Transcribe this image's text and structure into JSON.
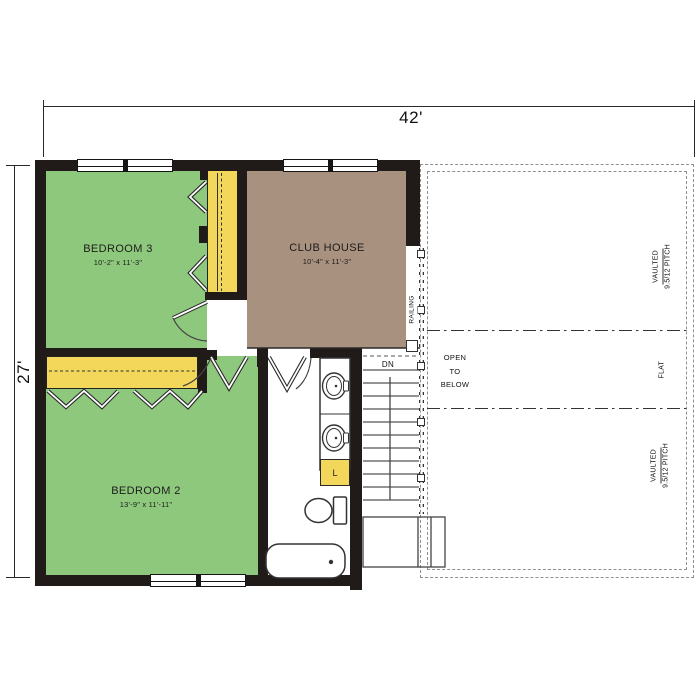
{
  "title": "Second floor plan",
  "dimensions": {
    "top": "42'",
    "left": "27'"
  },
  "rooms": [
    {
      "name": "BEDROOM 3",
      "size": "10'-2\" x 11'-3\"",
      "color": "#8ec87d"
    },
    {
      "name": "CLUB HOUSE",
      "size": "10'-4\" x 11'-3\"",
      "color": "#a9917f"
    },
    {
      "name": "BEDROOM 2",
      "size": "13'-9\" x 11'-11\"",
      "color": "#8ec87d"
    }
  ],
  "labels": {
    "down": "DN",
    "railing": "RAILING",
    "open_line1": "OPEN",
    "open_line2": "TO",
    "open_line3": "BELOW",
    "linen": "L",
    "vaulted": "VAULTED",
    "pitch": "9.5/12 PITCH",
    "flat": "FLAT"
  },
  "colors": {
    "bedroom_green": "#8ec87d",
    "closet_yellow": "#f3d75a",
    "clubhouse_brown": "#a9917f",
    "wall_black": "#201b18"
  }
}
